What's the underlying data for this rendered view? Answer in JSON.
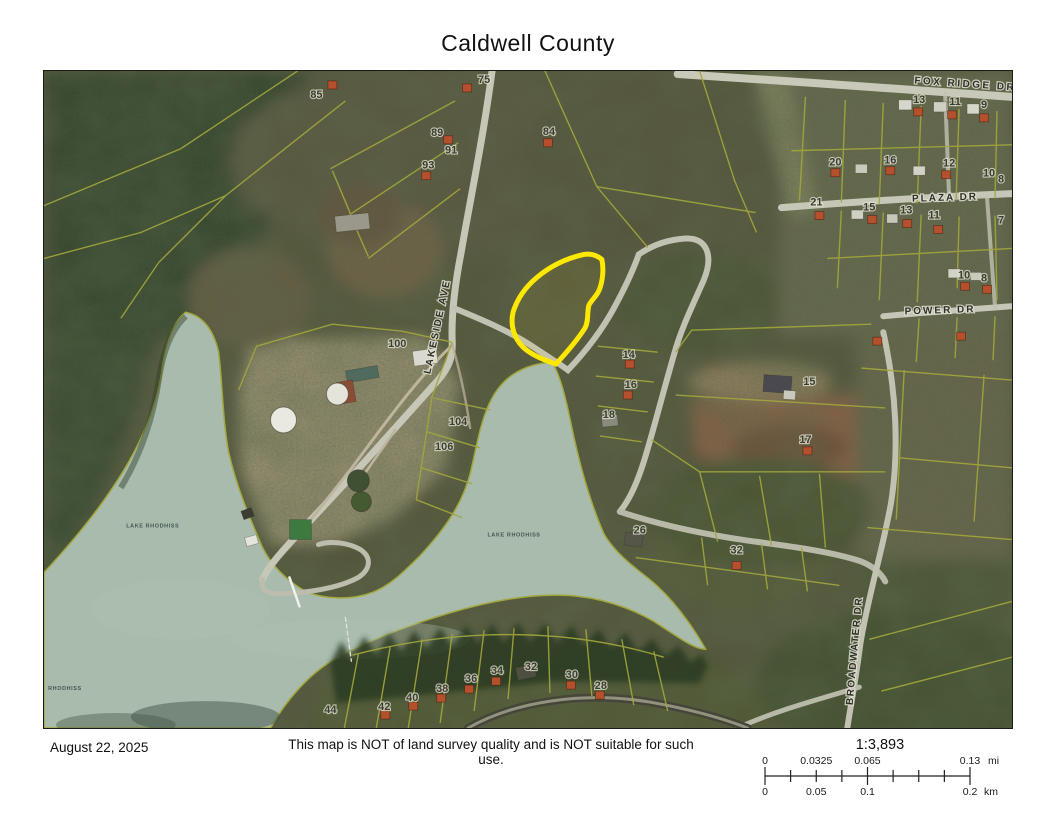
{
  "title": "Caldwell County",
  "footer": {
    "date": "August 22, 2025",
    "disclaimer": "This map is NOT of land survey quality and is NOT suitable for such use."
  },
  "scalebar": {
    "ratio": "1:3,893",
    "miles": {
      "labels": [
        "0",
        "0.0325",
        "0.065",
        "0.13"
      ],
      "positions": [
        0,
        0.25,
        0.5,
        1
      ],
      "unit": "mi"
    },
    "km": {
      "labels": [
        "0",
        "0.05",
        "0.1",
        "0.2"
      ],
      "positions": [
        0,
        0.25,
        0.5,
        1
      ],
      "unit": "km"
    }
  },
  "map": {
    "road_labels": [
      {
        "text": "FOX RIDGE DR",
        "x": 966,
        "y": 86,
        "rot": 4,
        "size": 10,
        "spacing": 2.5
      },
      {
        "text": "PLAZA DR",
        "x": 946,
        "y": 200,
        "rot": -2,
        "size": 10,
        "spacing": 2
      },
      {
        "text": "POWER DR",
        "x": 941,
        "y": 313,
        "rot": -2,
        "size": 10,
        "spacing": 2
      },
      {
        "text": "LAKESIDE AVE",
        "x": 440,
        "y": 327,
        "rot": -78,
        "size": 10,
        "spacing": 2
      },
      {
        "text": "BROADWATER DR",
        "x": 858,
        "y": 652,
        "rot": -85,
        "size": 9.5,
        "spacing": 1.5
      }
    ],
    "water_labels": [
      {
        "text": "LAKE RHODHISS",
        "x": 152,
        "y": 528,
        "size": 5.5
      },
      {
        "text": "LAKE RHODHISS",
        "x": 514,
        "y": 537,
        "size": 5.5
      },
      {
        "text": "RHODHISS",
        "x": 64,
        "y": 691,
        "size": 5.5
      }
    ],
    "parcel_numbers": [
      {
        "n": "85",
        "x": 316,
        "y": 97
      },
      {
        "n": "75",
        "x": 484,
        "y": 82
      },
      {
        "n": "89",
        "x": 437,
        "y": 135
      },
      {
        "n": "91",
        "x": 451,
        "y": 153
      },
      {
        "n": "93",
        "x": 428,
        "y": 168
      },
      {
        "n": "84",
        "x": 549,
        "y": 134
      },
      {
        "n": "100",
        "x": 397,
        "y": 347
      },
      {
        "n": "104",
        "x": 458,
        "y": 425
      },
      {
        "n": "106",
        "x": 444,
        "y": 450
      },
      {
        "n": "13",
        "x": 920,
        "y": 102
      },
      {
        "n": "11",
        "x": 956,
        "y": 104
      },
      {
        "n": "9",
        "x": 985,
        "y": 107
      },
      {
        "n": "20",
        "x": 836,
        "y": 165
      },
      {
        "n": "16",
        "x": 891,
        "y": 163
      },
      {
        "n": "12",
        "x": 950,
        "y": 166
      },
      {
        "n": "10",
        "x": 990,
        "y": 176
      },
      {
        "n": "8",
        "x": 1002,
        "y": 182
      },
      {
        "n": "21",
        "x": 817,
        "y": 205
      },
      {
        "n": "15",
        "x": 870,
        "y": 210
      },
      {
        "n": "13",
        "x": 907,
        "y": 213
      },
      {
        "n": "11",
        "x": 935,
        "y": 218
      },
      {
        "n": "7",
        "x": 1002,
        "y": 223
      },
      {
        "n": "10",
        "x": 965,
        "y": 278
      },
      {
        "n": "8",
        "x": 985,
        "y": 281
      },
      {
        "n": "14",
        "x": 629,
        "y": 358
      },
      {
        "n": "16",
        "x": 631,
        "y": 388
      },
      {
        "n": "18",
        "x": 609,
        "y": 418
      },
      {
        "n": "15",
        "x": 810,
        "y": 385
      },
      {
        "n": "17",
        "x": 806,
        "y": 443
      },
      {
        "n": "26",
        "x": 640,
        "y": 534
      },
      {
        "n": "32",
        "x": 737,
        "y": 554
      },
      {
        "n": "44",
        "x": 330,
        "y": 714
      },
      {
        "n": "42",
        "x": 384,
        "y": 711
      },
      {
        "n": "40",
        "x": 412,
        "y": 702
      },
      {
        "n": "38",
        "x": 442,
        "y": 693
      },
      {
        "n": "36",
        "x": 471,
        "y": 683
      },
      {
        "n": "34",
        "x": 497,
        "y": 675
      },
      {
        "n": "32",
        "x": 531,
        "y": 671
      },
      {
        "n": "30",
        "x": 572,
        "y": 679
      },
      {
        "n": "28",
        "x": 601,
        "y": 690
      }
    ],
    "houses": [
      [
        332,
        84
      ],
      [
        467,
        87
      ],
      [
        448,
        139
      ],
      [
        426,
        175
      ],
      [
        548,
        142
      ],
      [
        919,
        111
      ],
      [
        953,
        114
      ],
      [
        985,
        117
      ],
      [
        836,
        172
      ],
      [
        891,
        170
      ],
      [
        947,
        174
      ],
      [
        820,
        215
      ],
      [
        873,
        219
      ],
      [
        908,
        223
      ],
      [
        939,
        229
      ],
      [
        966,
        286
      ],
      [
        988,
        289
      ],
      [
        630,
        364
      ],
      [
        628,
        395
      ],
      [
        808,
        451
      ],
      [
        737,
        566
      ],
      [
        878,
        341
      ],
      [
        962,
        336
      ],
      [
        385,
        716
      ],
      [
        413,
        707
      ],
      [
        441,
        699
      ],
      [
        469,
        690
      ],
      [
        496,
        682
      ],
      [
        571,
        686
      ],
      [
        600,
        696
      ]
    ],
    "buildings": [
      {
        "x": 362,
        "y": 374,
        "w": 32,
        "h": 12,
        "rot": -10,
        "fill": "#4e6b5d"
      },
      {
        "x": 346,
        "y": 392,
        "w": 16,
        "h": 22,
        "rot": -10,
        "fill": "#8a4c34"
      },
      {
        "x": 425,
        "y": 357,
        "w": 24,
        "h": 15,
        "rot": -8,
        "fill": "#d9d9cf"
      },
      {
        "x": 352,
        "y": 222,
        "w": 34,
        "h": 16,
        "rot": -6,
        "fill": "#99988a"
      },
      {
        "x": 300,
        "y": 530,
        "w": 22,
        "h": 20,
        "rot": 0,
        "fill": "#3e7a3f"
      },
      {
        "x": 778,
        "y": 384,
        "w": 28,
        "h": 17,
        "rot": 4,
        "fill": "#49494f"
      },
      {
        "x": 790,
        "y": 395,
        "w": 12,
        "h": 9,
        "rot": 4,
        "fill": "#c9c9bd"
      },
      {
        "x": 610,
        "y": 421,
        "w": 16,
        "h": 11,
        "rot": -6,
        "fill": "#8b8b7d"
      },
      {
        "x": 634,
        "y": 540,
        "w": 18,
        "h": 13,
        "rot": 8,
        "fill": "#55554a"
      },
      {
        "x": 526,
        "y": 673,
        "w": 19,
        "h": 13,
        "rot": -12,
        "fill": "#4e4e42"
      },
      {
        "x": 247,
        "y": 514,
        "w": 11,
        "h": 9,
        "rot": -20,
        "fill": "#3c3c34"
      },
      {
        "x": 251,
        "y": 541,
        "w": 12,
        "h": 9,
        "rot": -15,
        "fill": "#e4e4da"
      },
      {
        "x": 906,
        "y": 104,
        "w": 13,
        "h": 10,
        "rot": 0,
        "fill": "#d6d6ca"
      },
      {
        "x": 941,
        "y": 106,
        "w": 13,
        "h": 10,
        "rot": 0,
        "fill": "#cfcfc2"
      },
      {
        "x": 974,
        "y": 108,
        "w": 12,
        "h": 10,
        "rot": 0,
        "fill": "#d6d6ca"
      },
      {
        "x": 862,
        "y": 168,
        "w": 12,
        "h": 9,
        "rot": 0,
        "fill": "#c9c9bc"
      },
      {
        "x": 920,
        "y": 170,
        "w": 12,
        "h": 9,
        "rot": 0,
        "fill": "#d2d2c6"
      },
      {
        "x": 858,
        "y": 214,
        "w": 12,
        "h": 9,
        "rot": 0,
        "fill": "#cfcfc2"
      },
      {
        "x": 893,
        "y": 218,
        "w": 11,
        "h": 9,
        "rot": 0,
        "fill": "#c6c6b9"
      },
      {
        "x": 955,
        "y": 273,
        "w": 12,
        "h": 9,
        "rot": 0,
        "fill": "#d2d2c6"
      },
      {
        "x": 977,
        "y": 276,
        "w": 11,
        "h": 8,
        "rot": 0,
        "fill": "#c9c9bc"
      }
    ],
    "tanks": [
      {
        "x": 283,
        "y": 420,
        "r": 13,
        "fill": "#e9e9e1"
      },
      {
        "x": 337,
        "y": 394,
        "r": 11,
        "fill": "#e4e4da"
      },
      {
        "x": 358,
        "y": 481,
        "r": 11,
        "fill": "#3f5132"
      },
      {
        "x": 361,
        "y": 502,
        "r": 10,
        "fill": "#455a30"
      }
    ],
    "colors": {
      "water": "#a8bbac",
      "parcel_line": "#a2a73c",
      "highlight": "#ffe800",
      "road": "#c7c7b8",
      "house": "#b5502d"
    }
  }
}
